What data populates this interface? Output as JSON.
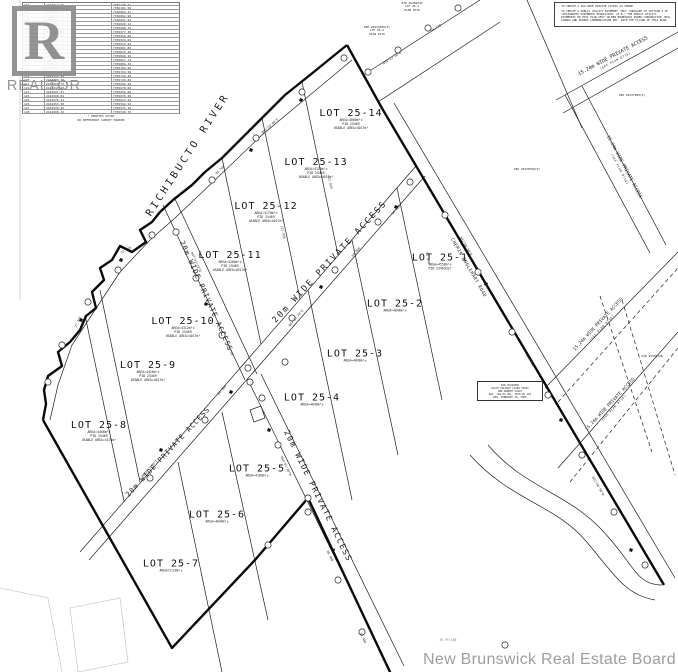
{
  "plan": {
    "watermark": "New Brunswick Real Estate Board",
    "river_label": "RICHIBUCTO RIVER",
    "logo": {
      "letter": "R",
      "word": "REALTOR"
    }
  },
  "notes_box": {
    "items": [
      "TO CREATE A 20m WIDE PRIVATE ACCESS AS SHOWN.",
      "TO CREATE A PUBLIC UTILITY EASEMENT 'MAY' PURSUANT TO SECTION 5 OF 'DESIGNATED EASEMENTS REGULATION' (N.B.) THE PUBLIC UTILITY EASEMENTS ON THIS PLAN VEST IN NEW BRUNSWICK POWER CORPORATION, BELL CANADA AND ROGERS COMMUNICATION INC. WITH THE FILING OF THIS PLAN."
    ]
  },
  "coordinate_table": {
    "rows": [
      [
        "101",
        "2443512.66",
        "7356128.31"
      ],
      [
        "102",
        "2443498.12",
        "7356101.58"
      ],
      [
        "103",
        "2443475.89",
        "7356084.27"
      ],
      [
        "104",
        "2443451.34",
        "7356062.90"
      ],
      [
        "105",
        "2443428.71",
        "7356041.52"
      ],
      [
        "106",
        "2443406.18",
        "7356020.14"
      ],
      [
        "107",
        "2443383.55",
        "7355998.76"
      ],
      [
        "108",
        "2443360.92",
        "7355977.38"
      ],
      [
        "109",
        "2443338.29",
        "7355956.00"
      ],
      [
        "110",
        "2443315.66",
        "7355934.62"
      ],
      [
        "111",
        "2443293.03",
        "7355913.24"
      ],
      [
        "112",
        "2443270.40",
        "7355891.86"
      ],
      [
        "113",
        "2443247.77",
        "7355870.48"
      ],
      [
        "114",
        "2443225.14",
        "7355849.10"
      ],
      [
        "115",
        "2443202.51",
        "7355827.72"
      ],
      [
        "116",
        "2443179.88",
        "7355806.34"
      ],
      [
        "117",
        "2443157.25",
        "7355784.96"
      ],
      [
        "118",
        "2443134.62",
        "7355763.58"
      ],
      [
        "119",
        "2443111.99",
        "7355742.20"
      ],
      [
        "120",
        "2443089.36",
        "7355720.82"
      ],
      [
        "121",
        "2443066.73",
        "7355699.44"
      ],
      [
        "122",
        "2443044.10",
        "7355678.06"
      ],
      [
        "123",
        "2443021.47",
        "7355656.68"
      ],
      [
        "124",
        "2442998.84",
        "7355635.30"
      ],
      [
        "125",
        "2442976.21",
        "7355613.92"
      ],
      [
        "126",
        "2442953.58",
        "7355592.54"
      ],
      [
        "127",
        "2442930.95",
        "7355571.16"
      ],
      [
        "128",
        "2442908.32",
        "7355549.78"
      ]
    ],
    "footnotes": [
      "* DENOTES POINT",
      "NO REFERENCE SURVEY MARKER"
    ]
  },
  "lots": [
    {
      "name": "LOT 25-1",
      "sub1": "AREA=4558m²±",
      "sub2": "PID 25469327"
    },
    {
      "name": "LOT 25-2",
      "sub1": "AREA=4046m²±"
    },
    {
      "name": "LOT 25-3",
      "sub1": "AREA=4046m²±"
    },
    {
      "name": "LOT 25-4",
      "sub1": "AREA=4046m²±"
    },
    {
      "name": "LOT 25-5",
      "sub1": "AREA=4180m²±"
    },
    {
      "name": "LOT 25-6",
      "sub1": "AREA=4046m²±"
    },
    {
      "name": "LOT 25-7",
      "sub1": "AREA=5120m²±"
    },
    {
      "name": "LOT 25-8",
      "sub1": "AREA=4466m²±",
      "sub2": "PID 25469",
      "sub3": "USABLE AREA=4131m²"
    },
    {
      "name": "LOT 25-9",
      "sub1": "AREA=4426m²±",
      "sub2": "PID 25469",
      "sub3": "USABLE AREA=4017m²"
    },
    {
      "name": "LOT 25-10",
      "sub1": "AREA=4312m²±",
      "sub2": "PID 25469",
      "sub3": "USABLE AREA=4017m²"
    },
    {
      "name": "LOT 25-11",
      "sub1": "AREA=4286m²±",
      "sub2": "PID 25469",
      "sub3": "USABLE AREA=4017m²"
    },
    {
      "name": "LOT 25-12",
      "sub1": "AREA=4178m²±",
      "sub2": "PID 25469",
      "sub3": "USABLE AREA=4017m²"
    },
    {
      "name": "LOT 25-13",
      "sub1": "AREA=4120m²±",
      "sub2": "PID 25469",
      "sub3": "USABLE AREA=4017m²"
    },
    {
      "name": "LOT 25-14",
      "sub1": "AREA=4066m²±",
      "sub2": "PID 25469",
      "sub3": "USABLE AREA=4017m²"
    }
  ],
  "roads": {
    "main_upper": "20m WIDE PRIVATE ACCESS",
    "main_lower": "20m WIDE PRIVATE ACCESS",
    "branch_upper": "20m WIDE PRIVATE ACCESS",
    "branch_lower": "20m WIDE PRIVATE ACCESS",
    "chemin": "CHEMIN ENGLEHART ROAD",
    "private_1524": "15.24m WIDE PRIVATE ACCESS",
    "see_plan": "(SEE PLAN 8716)"
  },
  "pids": {
    "a1": "PID 25469343",
    "a2": "LOT 26-1",
    "a3": "PLAN 8716",
    "b1": "PID 25434049(P)",
    "b2": "LOT 26-2",
    "b3": "PLAN 8716",
    "c": "PID 25439760(P)",
    "d": "PID 25437989(P)",
    "e": "PID 25435748"
  },
  "owner_box": {
    "l1": "PID 25434056",
    "l2": "ALICE VALANCE CLING VOIGT",
    "l3": "AND ROBERT VOIGT",
    "l4": "DOC. 104-03 VOL. 1070 PG 119",
    "l5": "REG. FEBRUARY 20, 1996"
  },
  "annotations": [
    {
      "t": "N42°17'40\"E",
      "x": 150,
      "y": 468,
      "r": -49
    },
    {
      "t": "60.960",
      "x": 222,
      "y": 390,
      "r": -49
    },
    {
      "t": "N42°17'40\"E",
      "x": 296,
      "y": 318,
      "r": -49
    },
    {
      "t": "60.960",
      "x": 356,
      "y": 252,
      "r": -49
    },
    {
      "t": "30.480",
      "x": 396,
      "y": 210,
      "r": -49
    },
    {
      "t": "N47°42'20\"W",
      "x": 196,
      "y": 262,
      "r": 66
    },
    {
      "t": "45.720",
      "x": 230,
      "y": 350,
      "r": 66
    },
    {
      "t": "N44°02'30\"W",
      "x": 286,
      "y": 466,
      "r": 64
    },
    {
      "t": "60.960",
      "x": 330,
      "y": 556,
      "r": 64
    },
    {
      "t": "N51°33'40\"E",
      "x": 270,
      "y": 126,
      "r": -42
    },
    {
      "t": "48.768",
      "x": 220,
      "y": 170,
      "r": -42
    },
    {
      "t": "32.004",
      "x": 126,
      "y": 250,
      "r": -30
    },
    {
      "t": "27.432",
      "x": 78,
      "y": 322,
      "r": -65
    },
    {
      "t": "N56°22'10\"E",
      "x": 392,
      "y": 58,
      "r": -33
    },
    {
      "t": "45.720",
      "x": 436,
      "y": 28,
      "r": -33
    },
    {
      "t": "N32°40'50\"W",
      "x": 466,
      "y": 246,
      "r": 60
    },
    {
      "t": "121.920",
      "x": 530,
      "y": 360,
      "r": 60
    },
    {
      "t": "N32°40'50\"W",
      "x": 598,
      "y": 486,
      "r": 60
    },
    {
      "t": "121.920",
      "x": 330,
      "y": 182,
      "r": 78
    },
    {
      "t": "121.920",
      "x": 283,
      "y": 232,
      "r": 78
    },
    {
      "t": "91.440",
      "x": 428,
      "y": 258,
      "r": 80
    },
    {
      "t": "30.480",
      "x": 363,
      "y": 638,
      "r": 64
    },
    {
      "t": "JR PFLSNE",
      "x": 448,
      "y": 640,
      "r": 0,
      "c": "#8a8a8a"
    }
  ]
}
